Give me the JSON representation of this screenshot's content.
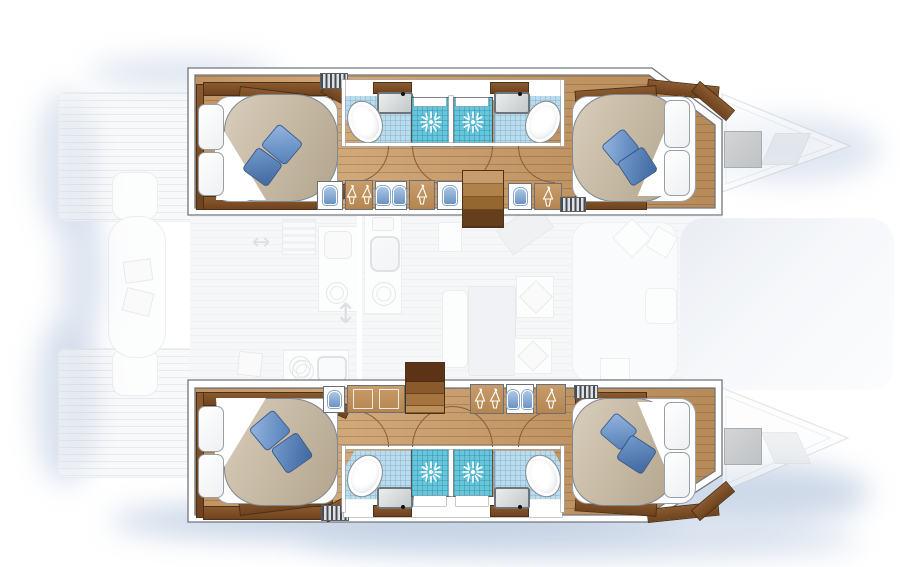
{
  "alt": "Top-down interior layout plan of a 4-cabin catamaran sailing yacht",
  "visible_text": [],
  "colors": {
    "background": "#ffffff",
    "wood_floor": "#c49a6c",
    "wood_trim_dark": "#7b4e28",
    "mattress_beige": "#c6b9a3",
    "pillow_blue_light": "#8fb1da",
    "pillow_blue_dark": "#4d79b2",
    "tile_blue": "#badcec",
    "tile_teal": "#68c5db",
    "wall_outline": "#70767c",
    "faded_line": "#d4d8dd",
    "glow_blue": "#b9c9e0",
    "stern_window_gray": "#c9cbcd"
  },
  "icons": [
    "shower-spray-icon",
    "hanger-icon",
    "locker-hatch-icon",
    "vent-grille",
    "door-swing-arc",
    "stove-burner-icon",
    "galley-sink-icon",
    "toilet-icon",
    "windlass-icon"
  ],
  "structure": {
    "port_hull_top": {
      "rooms": [
        "forward-cabin-double-bed",
        "forward-bathroom-with-toilet-and-sink",
        "shower",
        "shower",
        "aft-bathroom-with-toilet-and-sink",
        "aft-cabin-double-bed"
      ],
      "corridor": [
        "locker-hatch",
        "hanging-wardrobe",
        "storage-bins",
        "hanging-wardrobe",
        "locker-hatch",
        "companionway-stairs",
        "storage-bins",
        "hanging-wardrobe",
        "vent-grille"
      ]
    },
    "starboard_hull_bottom": {
      "rooms": [
        "forward-cabin-double-bed",
        "forward-bathroom-with-toilet-and-sink",
        "shower",
        "shower",
        "aft-bathroom-with-toilet-and-sink",
        "aft-cabin-double-bed"
      ],
      "corridor": [
        "locker-hatch",
        "low-cabinet",
        "companionway-stairs",
        "hanging-wardrobe",
        "storage-bins",
        "hanging-wardrobe",
        "vent-grille"
      ]
    },
    "center_faded_deck": [
      "foredeck-with-anchor-windlass",
      "mast-beam-structure",
      "galley-counters-sink-stove",
      "dining-table-with-seats",
      "cockpit-bench-and-table",
      "aft-platform"
    ],
    "bed_count": 4,
    "shower_count": 4,
    "toilet_count": 4
  }
}
